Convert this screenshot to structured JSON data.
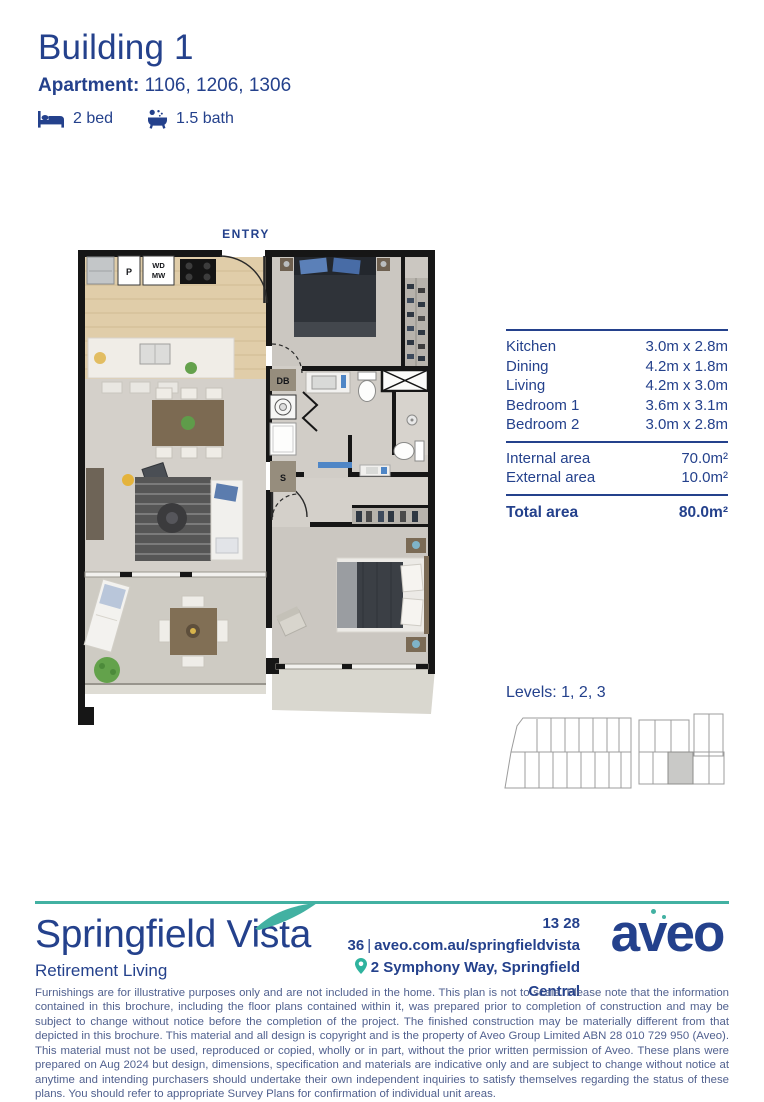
{
  "header": {
    "title": "Building 1",
    "apartment_label": "Apartment:",
    "apartment_numbers": "1106, 1206, 1306",
    "bed": "2 bed",
    "bath": "1.5 bath"
  },
  "floorplan": {
    "entry_label": "ENTRY",
    "labels": {
      "pantry": "P",
      "washer_dryer": "WD",
      "microwave": "MW",
      "distribution_board": "DB",
      "storage": "S"
    }
  },
  "dimensions": {
    "rooms": [
      {
        "label": "Kitchen",
        "size": "3.0m x 2.8m"
      },
      {
        "label": "Dining",
        "size": "4.2m x 1.8m"
      },
      {
        "label": "Living",
        "size": "4.2m x 3.0m"
      },
      {
        "label": "Bedroom 1",
        "size": "3.6m x 3.1m"
      },
      {
        "label": "Bedroom 2",
        "size": "3.0m x 2.8m"
      }
    ],
    "areas": [
      {
        "label": "Internal area",
        "value": "70.0m²"
      },
      {
        "label": "External area",
        "value": "10.0m²"
      }
    ],
    "total": {
      "label": "Total area",
      "value": "80.0m²"
    }
  },
  "levels": {
    "label": "Levels: 1, 2, 3"
  },
  "footer": {
    "brand": "Springfield Vista",
    "brand_sub": "Retirement Living",
    "phone": "13 28 36",
    "separator": "|",
    "url": "aveo.com.au/springfieldvista",
    "address": "2 Symphony Way, Springfield Central",
    "logo": "aveo"
  },
  "disclaimer": "Furnishings are for illustrative purposes only and are not included in the home. This plan is not to scale. Please note that the information contained in this brochure, including the floor plans contained within it, was prepared prior to completion of construction and may be subject to change without notice before the completion of the project. The finished construction may be materially different from that depicted in this brochure. This material and all design is copyright and is the property of Aveo Group Limited ABN 28 010 729 950 (Aveo). This material must not be used, reproduced or copied, wholly or in part, without the prior written permission of Aveo. These plans were prepared on Aug 2024 but design, dimensions, specification and materials are indicative only and are subject to change without notice at anytime and intending purchasers should undertake their own independent inquiries to satisfy themselves regarding the status of these plans. You should refer to appropriate Survey Plans for confirmation of individual unit areas.",
  "colors": {
    "navy": "#24418C",
    "teal": "#42B1A2",
    "disclaimer_text": "#51618F",
    "plan_wall": "#161616",
    "highlight_unit": "#C9C9C7"
  }
}
